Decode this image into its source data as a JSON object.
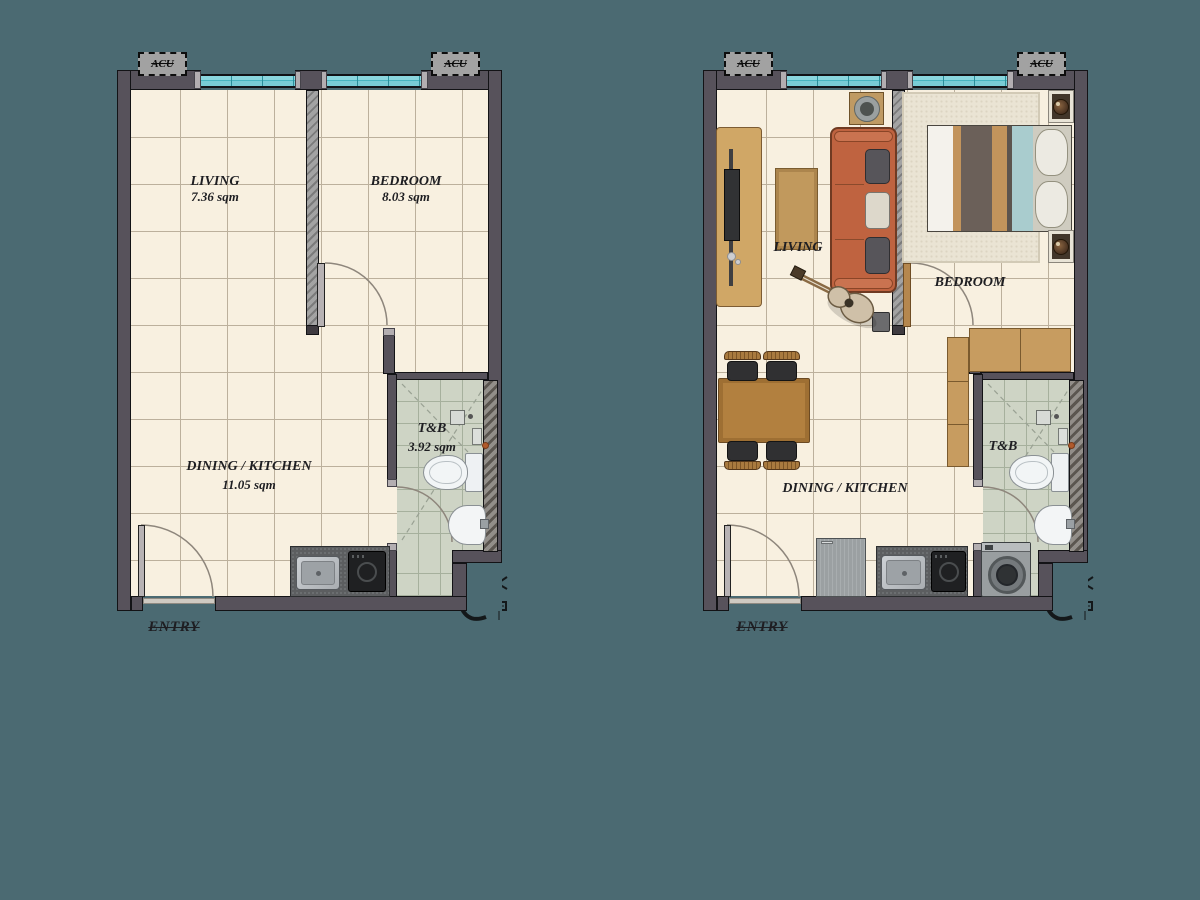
{
  "background_color": "#4b6a72",
  "palette": {
    "wall": "#57525b",
    "floor": "#f8f0e0",
    "window": "#74ccd5",
    "bath_tile": "#ced4c5",
    "wood": "#c0935c",
    "sofa": "#bf6340",
    "counter": "#5c5e60"
  },
  "plans": {
    "unfurnished": {
      "acu_left": "ACU",
      "acu_right": "ACU",
      "entry_label": "ENTRY",
      "rooms": {
        "living": {
          "name": "LIVING",
          "area": "7.36 sqm"
        },
        "bedroom": {
          "name": "BEDROOM",
          "area": "8.03 sqm"
        },
        "dining_kitchen": {
          "name": "DINING / KITCHEN",
          "area": "11.05 sqm"
        },
        "toilet_bath": {
          "name": "T&B",
          "area": "3.92 sqm"
        }
      }
    },
    "furnished": {
      "acu_left": "ACU",
      "acu_right": "ACU",
      "entry_label": "ENTRY",
      "rooms": {
        "living": {
          "name": "LIVING"
        },
        "bedroom": {
          "name": "BEDROOM"
        },
        "dining_kitchen": {
          "name": "DINING / KITCHEN"
        },
        "toilet_bath": {
          "name": "T&B"
        }
      }
    }
  }
}
